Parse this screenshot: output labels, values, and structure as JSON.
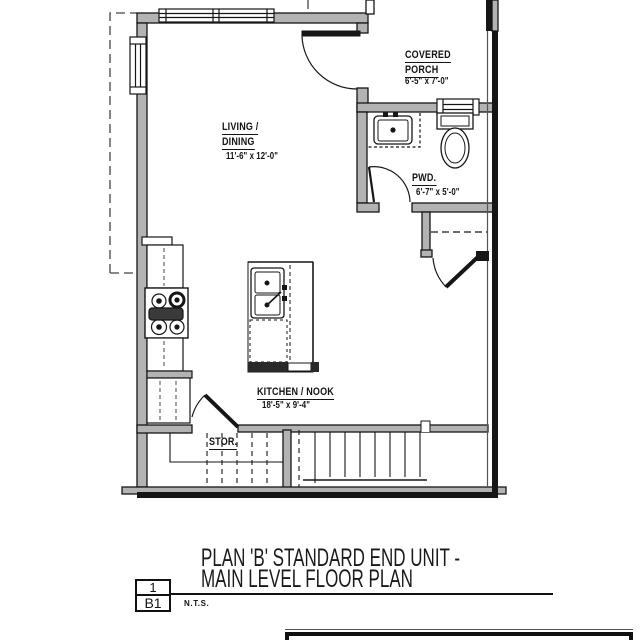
{
  "plan": {
    "rooms": {
      "living_dining": {
        "label1": "LIVING /",
        "label2": "DINING",
        "dim": "11'-6\" x 12'-0\""
      },
      "covered_porch": {
        "label1": "COVERED",
        "label2": "PORCH",
        "dim": "6'-5\" x 7'-0\""
      },
      "powder": {
        "label": "PWD.",
        "dim": "6'-7\" x 5'-0\""
      },
      "kitchen_nook": {
        "label": "KITCHEN / NOOK",
        "dim": "18'-5\" x 9'-4\""
      },
      "storage": {
        "label": "STOR."
      }
    },
    "title": {
      "line1": "PLAN 'B' STANDARD END UNIT -",
      "line2": "MAIN LEVEL FLOOR PLAN"
    },
    "title_block": {
      "detail_number": "1",
      "sheet_number": "B1",
      "scale_note": "N.T.S."
    },
    "colors": {
      "wall_fill": "#b3b3b3",
      "line": "#161616",
      "background": "#ffffff"
    }
  }
}
